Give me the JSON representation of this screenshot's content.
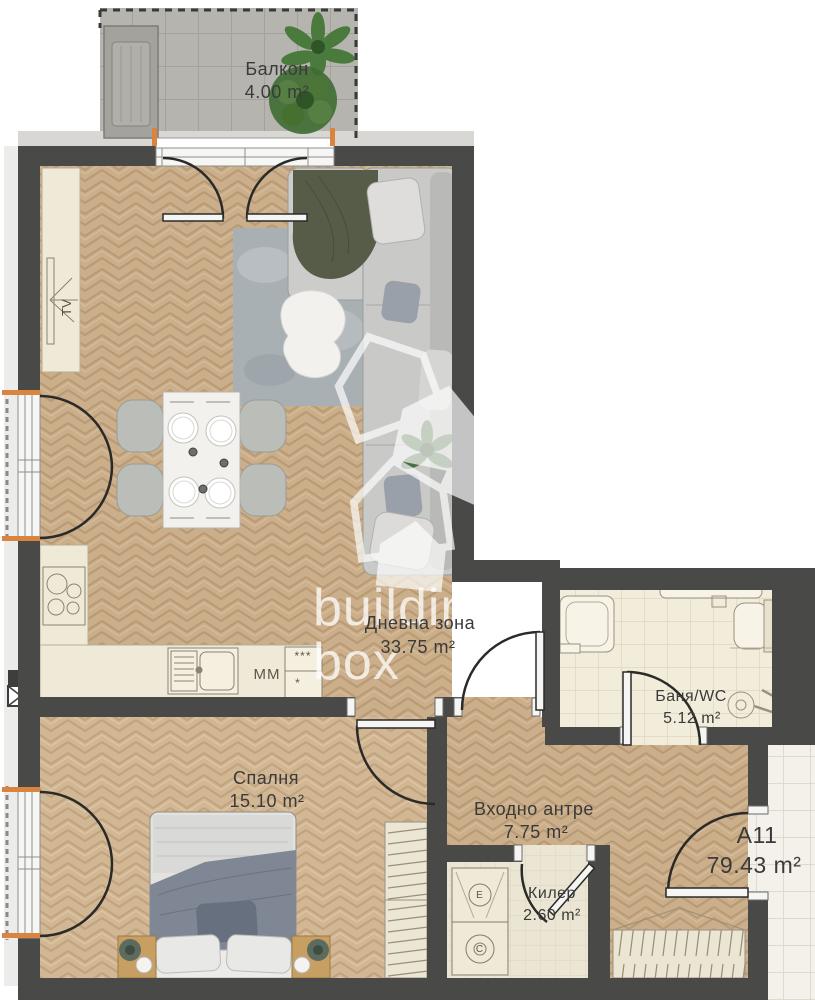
{
  "plan": {
    "unit": {
      "code": "А11",
      "area": "79.43 m²"
    },
    "rooms": [
      {
        "name": "Балкон",
        "area": "4.00 m²"
      },
      {
        "name": "Дневна зона",
        "area": "33.75 m²"
      },
      {
        "name": "Баня/WC",
        "area": "5.12 m²"
      },
      {
        "name": "Спалня",
        "area": "15.10 m²"
      },
      {
        "name": "Входно антре",
        "area": "7.75 m²"
      },
      {
        "name": "Килер",
        "area": "2.60 m²"
      }
    ],
    "appliance_labels": {
      "tv": "TV",
      "microwave": "MM",
      "fridge_stars": "***",
      "freezer_star": "*",
      "washer": "C",
      "dryer": "E"
    },
    "watermark": {
      "line1": "building",
      "line2": "box"
    },
    "colors": {
      "wall": "#494947",
      "wood": "#cbae8a",
      "accent_marker": "#d9853f",
      "balcony_tile": "#b5b4af",
      "bath_tile": "#f2ecda"
    }
  }
}
